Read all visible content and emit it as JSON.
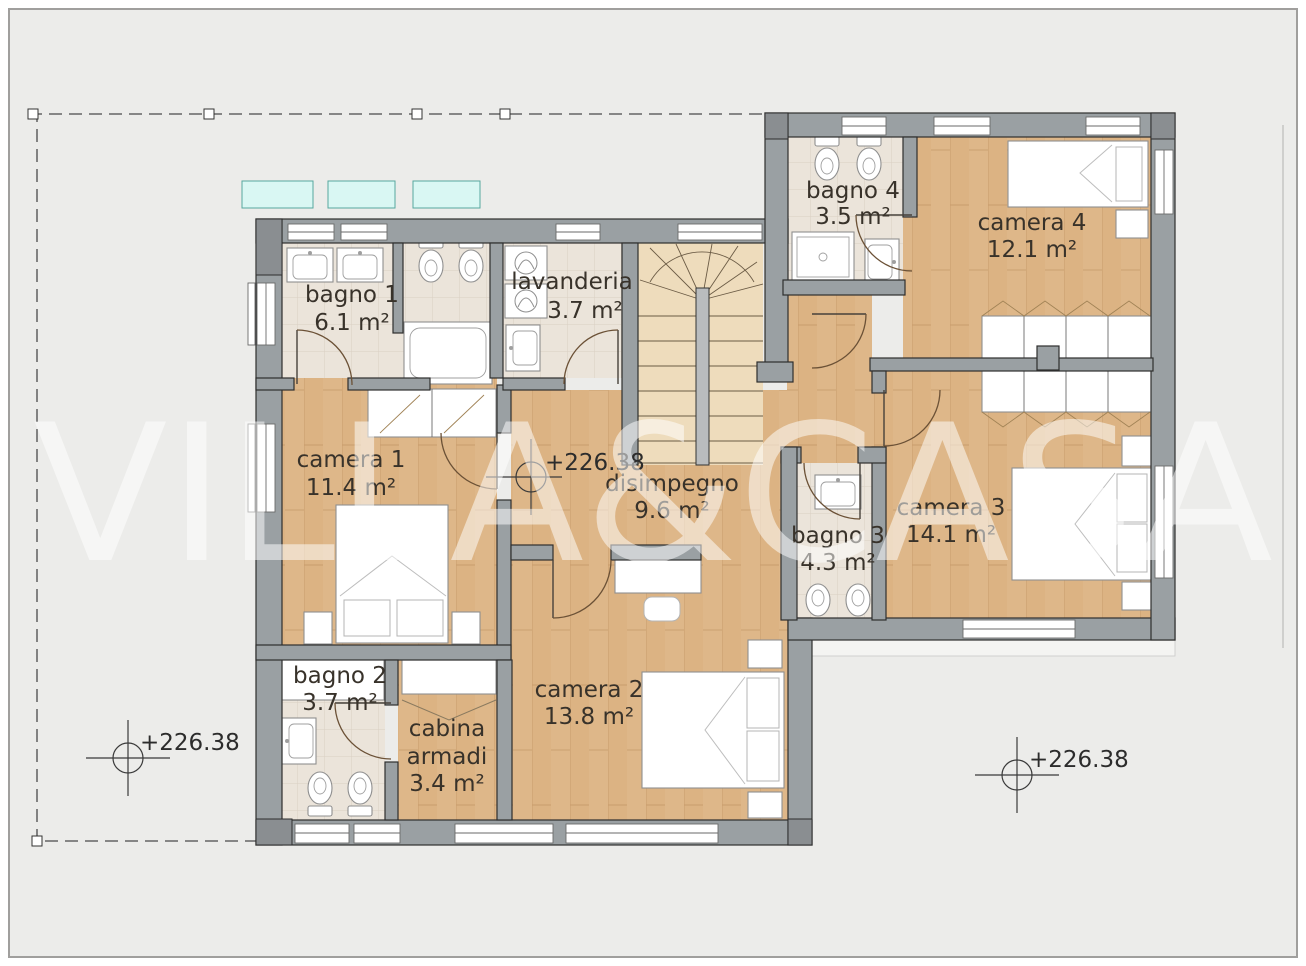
{
  "watermark": {
    "text": "VILLA&CASA"
  },
  "rooms": [
    {
      "name": "bagno 1",
      "area": "6.1 m²"
    },
    {
      "name": "lavanderia",
      "area": "3.7 m²"
    },
    {
      "name": "bagno 4",
      "area": "3.5 m²"
    },
    {
      "name": "camera 4",
      "area": "12.1 m²"
    },
    {
      "name": "camera 1",
      "area": "11.4 m²"
    },
    {
      "name": "disimpegno",
      "area": "9.6 m²"
    },
    {
      "name": "bagno 3",
      "area": "4.3 m²"
    },
    {
      "name": "camera 3",
      "area": "14.1 m²"
    },
    {
      "name": "bagno 2",
      "area": "3.7 m²"
    },
    {
      "name": "cabina armadi",
      "name_lines": [
        "cabina",
        "armadi"
      ],
      "area": "3.4 m²"
    },
    {
      "name": "camera 2",
      "area": "13.8 m²"
    }
  ],
  "markers": [
    {
      "label": "+226.38"
    },
    {
      "label": "+226.38"
    },
    {
      "label": "+226.38"
    }
  ],
  "colors": {
    "background": "#ececea",
    "wall": "#9aa0a3",
    "wood_floor": "#dcb383",
    "tile_floor": "#ebe4da",
    "stairs_floor": "#eedcbc",
    "skylight_fill": "#d9f7f3",
    "skylight_border": "#56a79f",
    "watermark": "#ffffff"
  }
}
